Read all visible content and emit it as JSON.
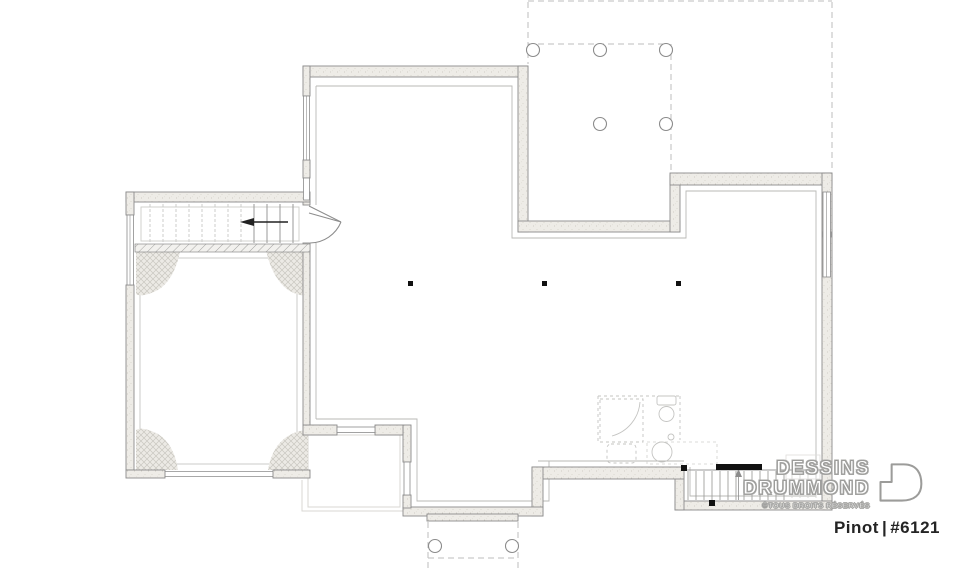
{
  "brand": {
    "line1": "DESSINS",
    "line2": "DRUMMOND",
    "copyright": "©TOUS DROITS RÉSERVÉS"
  },
  "plan": {
    "name": "Pinot",
    "separator": "|",
    "number": "#6121"
  },
  "drawing": {
    "type": "basement-foundation-floor-plan",
    "elements": {
      "deck_above_posts": 5,
      "porch_below_posts": 2,
      "support_posts": 3
    }
  },
  "colors": {
    "wall_fill": "#edebe6",
    "wall_outline": "#8b8b8b",
    "light_line": "#c6c6c4",
    "dashed_line": "#bdbdbd",
    "solid_black": "#111111",
    "logo_outline": "#9c9c9a",
    "label_text": "#242424"
  },
  "icons": {
    "logo_house": "drummond-house-icon"
  }
}
